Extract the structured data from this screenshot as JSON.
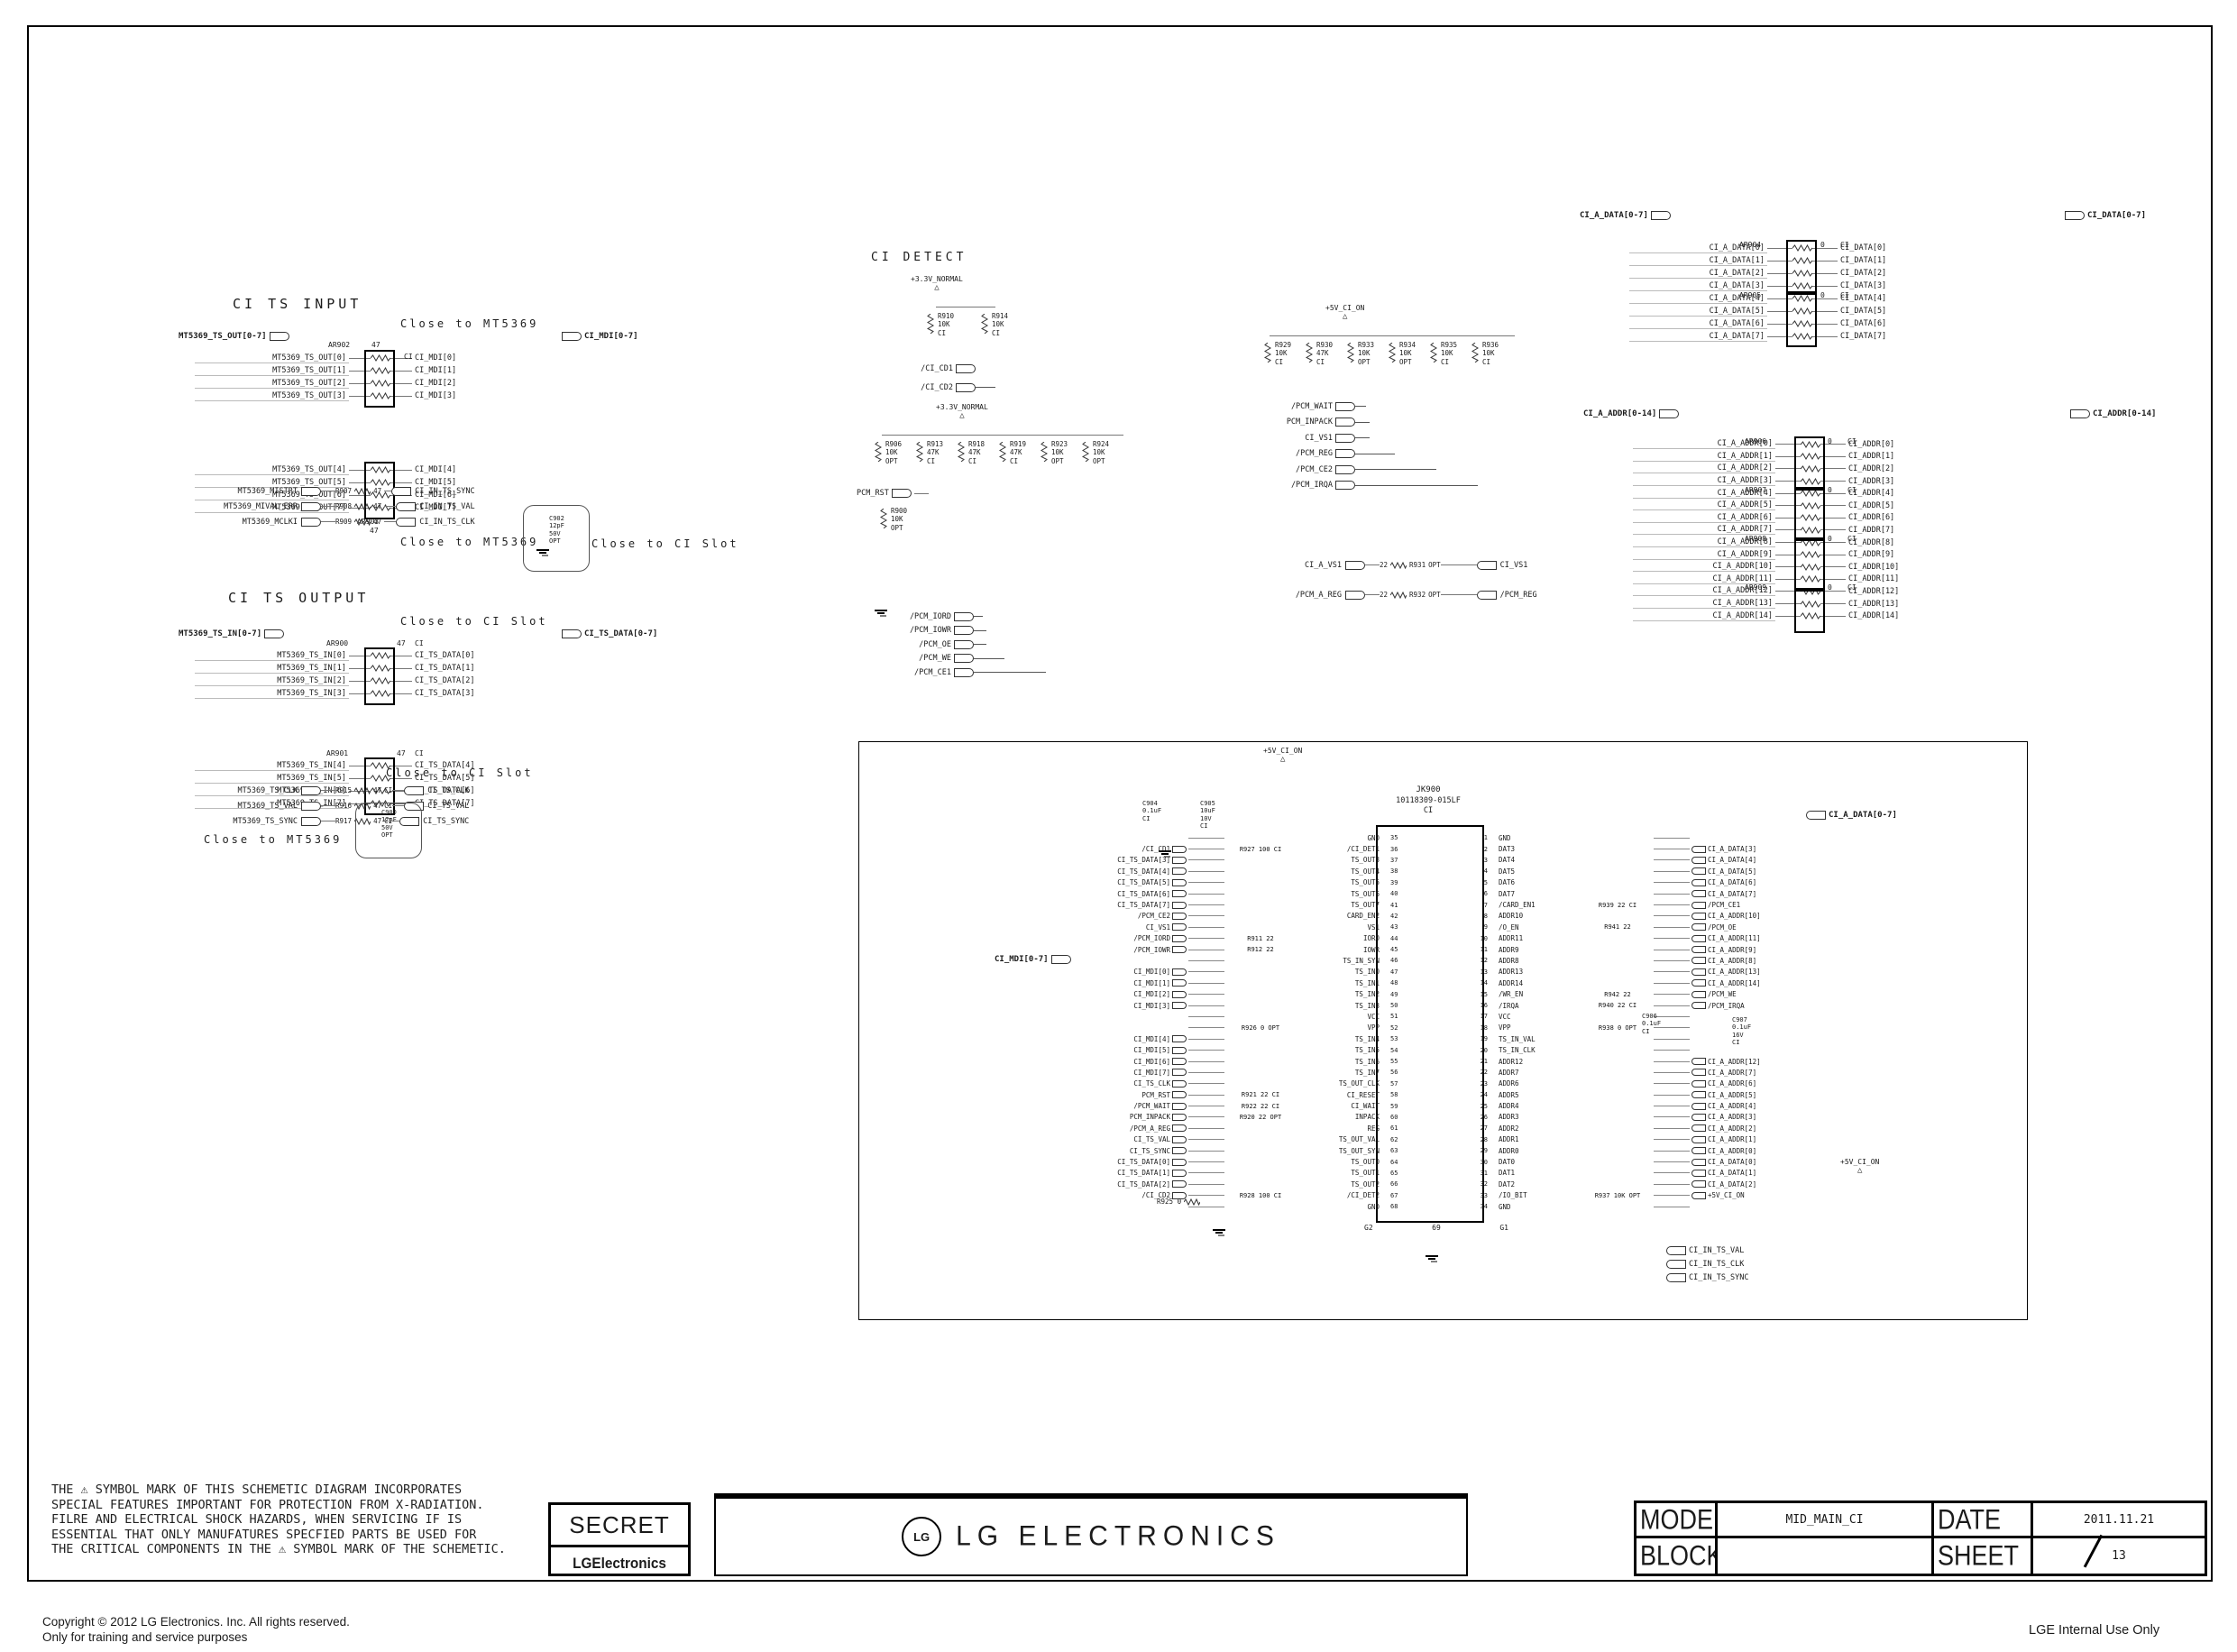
{
  "page": {
    "copyright1": "Copyright © 2012 LG Electronics. Inc. All rights reserved.",
    "copyright2": "Only for training and service purposes",
    "internal": "LGE Internal Use Only"
  },
  "legend": {
    "disclaimer": [
      "THE ⚠ SYMBOL MARK OF THIS SCHEMETIC DIAGRAM INCORPORATES",
      "SPECIAL FEATURES IMPORTANT FOR PROTECTION FROM X-RADIATION.",
      "FILRE AND ELECTRICAL SHOCK HAZARDS, WHEN SERVICING IF IS",
      "ESSENTIAL THAT ONLY MANUFATURES SPECFIED PARTS BE USED FOR",
      "THE CRITICAL COMPONENTS IN THE ⚠ SYMBOL MARK OF THE SCHEMETIC."
    ],
    "secret": "SECRET",
    "lg_small": "LGElectronics",
    "logo_circle": "LG",
    "logo_text": "LG ELECTRONICS",
    "model_label": "MODEL",
    "model": "MID_MAIN_CI",
    "date_label": "DATE",
    "date": "2011.11.21",
    "block_label": "BLOCK",
    "block": "",
    "sheet_label": "SHEET",
    "sheet": "13"
  },
  "ci_ts_input": {
    "title": "CI TS INPUT",
    "close1": "Close to MT5369",
    "close2": "Close to MT5369",
    "close3": "Close to CI Slot",
    "bus_in": "MT5369_TS_OUT[0-7]",
    "bus_out": "CI_MDI[0-7]",
    "net1": {
      "ref": "AR902",
      "val": "47",
      "tag": "CI"
    },
    "net2": {
      "ref": "AR903",
      "val": "47",
      "tag": "CI"
    },
    "rows1": [
      {
        "l": "MT5369_TS_OUT[0]",
        "r": "CI_MDI[0]"
      },
      {
        "l": "MT5369_TS_OUT[1]",
        "r": "CI_MDI[1]"
      },
      {
        "l": "MT5369_TS_OUT[2]",
        "r": "CI_MDI[2]"
      },
      {
        "l": "MT5369_TS_OUT[3]",
        "r": "CI_MDI[3]"
      }
    ],
    "rows2": [
      {
        "l": "MT5369_TS_OUT[4]",
        "r": "CI_MDI[4]"
      },
      {
        "l": "MT5369_TS_OUT[5]",
        "r": "CI_MDI[5]"
      },
      {
        "l": "MT5369_TS_OUT[6]",
        "r": "CI_MDI[6]"
      },
      {
        "l": "MT5369_TS_OUT[7]",
        "r": "CI_MDI[7]"
      }
    ],
    "series": [
      {
        "l": "MT5369_MISTRT",
        "ref": "R907",
        "val": "47",
        "tag": "",
        "r": "CI_IN_TS_SYNC"
      },
      {
        "l": "MT5369_MIVAL_ERR",
        "ref": "R908",
        "val": "47",
        "tag": "",
        "r": "CI_IN_TS_VAL"
      },
      {
        "l": "MT5369_MCLKI",
        "ref": "R909",
        "val": "47",
        "tag": "",
        "r": "CI_IN_TS_CLK"
      }
    ],
    "cap": {
      "ref": "C902",
      "v": "12pF",
      "volt": "50V",
      "tag": "OPT"
    }
  },
  "ci_ts_output": {
    "title": "CI TS OUTPUT",
    "close1": "Close to CI Slot",
    "close2": "Close to CI Slot",
    "close3": "Close to MT5369",
    "bus_in": "MT5369_TS_IN[0-7]",
    "bus_out": "CI_TS_DATA[0-7]",
    "net1": {
      "ref": "AR900",
      "val": "47",
      "tag": "CI"
    },
    "net2": {
      "ref": "AR901",
      "val": "47",
      "tag": "CI"
    },
    "rows1": [
      {
        "l": "MT5369_TS_IN[0]",
        "r": "CI_TS_DATA[0]"
      },
      {
        "l": "MT5369_TS_IN[1]",
        "r": "CI_TS_DATA[1]"
      },
      {
        "l": "MT5369_TS_IN[2]",
        "r": "CI_TS_DATA[2]"
      },
      {
        "l": "MT5369_TS_IN[3]",
        "r": "CI_TS_DATA[3]"
      }
    ],
    "rows2": [
      {
        "l": "MT5369_TS_IN[4]",
        "r": "CI_TS_DATA[4]"
      },
      {
        "l": "MT5369_TS_IN[5]",
        "r": "CI_TS_DATA[5]"
      },
      {
        "l": "MT5369_TS_IN[6]",
        "r": "CI_TS_DATA[6]"
      },
      {
        "l": "MT5369_TS_IN[7]",
        "r": "CI_TS_DATA[7]"
      }
    ],
    "series": [
      {
        "l": "MT5369_TS_CLK",
        "ref": "R915",
        "val": "47",
        "tag": "CI",
        "r": "CI_TS_CLK"
      },
      {
        "l": "MT5369_TS_VAL",
        "ref": "R916",
        "val": "47",
        "tag": "CI",
        "r": "CI_TS_VAL"
      },
      {
        "l": "MT5369_TS_SYNC",
        "ref": "R917",
        "val": "47",
        "tag": "CI",
        "r": "CI_TS_SYNC"
      }
    ],
    "cap": {
      "ref": "C900",
      "v": "12pF",
      "volt": "50V",
      "tag": "OPT"
    }
  },
  "ci_detect": {
    "title": "CI DETECT",
    "power": "+3.3V_NORMAL",
    "res": [
      {
        "ref": "R910",
        "val": "10K",
        "tag": "CI"
      },
      {
        "ref": "R914",
        "val": "10K",
        "tag": "CI"
      }
    ],
    "sigs": [
      "/CI_CD1",
      "/CI_CD2"
    ]
  },
  "pullup33": {
    "power": "+3.3V_NORMAL",
    "res": [
      {
        "ref": "R906",
        "val": "10K",
        "tag": "OPT"
      },
      {
        "ref": "R913",
        "val": "47K",
        "tag": "CI"
      },
      {
        "ref": "R918",
        "val": "47K",
        "tag": "CI"
      },
      {
        "ref": "R919",
        "val": "47K",
        "tag": "CI"
      },
      {
        "ref": "R923",
        "val": "10K",
        "tag": "OPT"
      },
      {
        "ref": "R924",
        "val": "10K",
        "tag": "OPT"
      }
    ],
    "pull_sig": "PCM_RST",
    "pull_res": {
      "ref": "R900",
      "val": "10K",
      "tag": "OPT"
    },
    "sigs": [
      "/PCM_IORD",
      "/PCM_IOWR",
      "/PCM_OE",
      "/PCM_WE",
      "/PCM_CE1"
    ]
  },
  "pullup5v": {
    "power": "+5V_CI_ON",
    "res": [
      {
        "ref": "R929",
        "val": "10K",
        "tag": "CI"
      },
      {
        "ref": "R930",
        "val": "47K",
        "tag": "CI"
      },
      {
        "ref": "R933",
        "val": "10K",
        "tag": "OPT"
      },
      {
        "ref": "R934",
        "val": "10K",
        "tag": "OPT"
      },
      {
        "ref": "R935",
        "val": "10K",
        "tag": "CI"
      },
      {
        "ref": "R936",
        "val": "10K",
        "tag": "CI"
      }
    ],
    "sigs": [
      "/PCM_WAIT",
      "PCM_INPACK",
      "CI_VS1",
      "/PCM_REG",
      "/PCM_CE2",
      "/PCM_IRQA"
    ],
    "jumpers": [
      {
        "l": "CI_A_VS1",
        "ref": "R931",
        "val": "22",
        "tag": "OPT",
        "r": "CI_VS1"
      },
      {
        "l": "/PCM_A_REG",
        "ref": "R932",
        "val": "22",
        "tag": "OPT",
        "r": "/PCM_REG"
      }
    ]
  },
  "databus": {
    "bus_in": "CI_A_DATA[0-7]",
    "bus_out": "CI_DATA[0-7]",
    "nets": [
      {
        "ref": "AR904",
        "val": "0",
        "tag": "CI"
      },
      {
        "ref": "AR905",
        "val": "0",
        "tag": "CI"
      }
    ],
    "rows": [
      {
        "l": "CI_A_DATA[0]",
        "r": "CI_DATA[0]"
      },
      {
        "l": "CI_A_DATA[1]",
        "r": "CI_DATA[1]"
      },
      {
        "l": "CI_A_DATA[2]",
        "r": "CI_DATA[2]"
      },
      {
        "l": "CI_A_DATA[3]",
        "r": "CI_DATA[3]"
      },
      {
        "l": "CI_A_DATA[4]",
        "r": "CI_DATA[4]"
      },
      {
        "l": "CI_A_DATA[5]",
        "r": "CI_DATA[5]"
      },
      {
        "l": "CI_A_DATA[6]",
        "r": "CI_DATA[6]"
      },
      {
        "l": "CI_A_DATA[7]",
        "r": "CI_DATA[7]"
      }
    ]
  },
  "addrbus": {
    "bus_in": "CI_A_ADDR[0-14]",
    "bus_out": "CI_ADDR[0-14]",
    "nets": [
      {
        "ref": "AR906",
        "val": "0",
        "tag": "CI"
      },
      {
        "ref": "AR907",
        "val": "0",
        "tag": "CI"
      },
      {
        "ref": "AR908",
        "val": "0",
        "tag": "CI"
      },
      {
        "ref": "AR909",
        "val": "0",
        "tag": "CI"
      }
    ],
    "rows": [
      {
        "l": "CI_A_ADDR[0]",
        "r": "CI_ADDR[0]"
      },
      {
        "l": "CI_A_ADDR[1]",
        "r": "CI_ADDR[1]"
      },
      {
        "l": "CI_A_ADDR[2]",
        "r": "CI_ADDR[2]"
      },
      {
        "l": "CI_A_ADDR[3]",
        "r": "CI_ADDR[3]"
      },
      {
        "l": "CI_A_ADDR[4]",
        "r": "CI_ADDR[4]"
      },
      {
        "l": "CI_A_ADDR[5]",
        "r": "CI_ADDR[5]"
      },
      {
        "l": "CI_A_ADDR[6]",
        "r": "CI_ADDR[6]"
      },
      {
        "l": "CI_A_ADDR[7]",
        "r": "CI_ADDR[7]"
      },
      {
        "l": "CI_A_ADDR[8]",
        "r": "CI_ADDR[8]"
      },
      {
        "l": "CI_A_ADDR[9]",
        "r": "CI_ADDR[9]"
      },
      {
        "l": "CI_A_ADDR[10]",
        "r": "CI_ADDR[10]"
      },
      {
        "l": "CI_A_ADDR[11]",
        "r": "CI_ADDR[11]"
      },
      {
        "l": "CI_A_ADDR[12]",
        "r": "CI_ADDR[12]"
      },
      {
        "l": "CI_A_ADDR[13]",
        "r": "CI_ADDR[13]"
      },
      {
        "l": "CI_A_ADDR[14]",
        "r": "CI_ADDR[14]"
      }
    ]
  },
  "main": {
    "power": "+5V_CI_ON",
    "power2": "+5V_CI_ON",
    "mdi_bus": "CI_MDI[0-7]",
    "data_bus": "CI_A_DATA[0-7]",
    "c904": {
      "ref": "C904",
      "v": "0.1uF",
      "tag": "CI"
    },
    "c905": {
      "ref": "C905",
      "v": "10uF",
      "volt": "10V",
      "tag": "CI"
    },
    "c906": {
      "ref": "C906",
      "v": "0.1uF",
      "tag": "CI"
    },
    "c907": {
      "ref": "C907",
      "v": "0.1uF",
      "volt": "16V",
      "tag": "CI"
    },
    "r925": "R925 0",
    "outs": [
      "CI_IN_TS_VAL",
      "CI_IN_TS_CLK",
      "CI_IN_TS_SYNC"
    ]
  },
  "ic": {
    "ref": "JK900",
    "part": "10118309-015LF",
    "tag": "CI",
    "g2": "G2",
    "p69": "69",
    "g1": "G1",
    "rows": [
      {
        "el": "",
        "lr": "",
        "ln": "GND",
        "lp": "35",
        "rp": "1",
        "rn": "GND",
        "rr": "",
        "er": ""
      },
      {
        "el": "/CI_CD1",
        "lr": "R927 100 CI",
        "ln": "/CI_DET1",
        "lp": "36",
        "rp": "2",
        "rn": "DAT3",
        "rr": "",
        "er": "CI_A_DATA[3]"
      },
      {
        "el": "CI_TS_DATA[3]",
        "lr": "",
        "ln": "TS_OUT3",
        "lp": "37",
        "rp": "3",
        "rn": "DAT4",
        "rr": "",
        "er": "CI_A_DATA[4]"
      },
      {
        "el": "CI_TS_DATA[4]",
        "lr": "",
        "ln": "TS_OUT4",
        "lp": "38",
        "rp": "4",
        "rn": "DAT5",
        "rr": "",
        "er": "CI_A_DATA[5]"
      },
      {
        "el": "CI_TS_DATA[5]",
        "lr": "",
        "ln": "TS_OUT5",
        "lp": "39",
        "rp": "5",
        "rn": "DAT6",
        "rr": "",
        "er": "CI_A_DATA[6]"
      },
      {
        "el": "CI_TS_DATA[6]",
        "lr": "",
        "ln": "TS_OUT6",
        "lp": "40",
        "rp": "6",
        "rn": "DAT7",
        "rr": "",
        "er": "CI_A_DATA[7]"
      },
      {
        "el": "CI_TS_DATA[7]",
        "lr": "",
        "ln": "TS_OUT7",
        "lp": "41",
        "rp": "7",
        "rn": "/CARD_EN1",
        "rr": "R939 22 CI",
        "er": "/PCM_CE1"
      },
      {
        "el": "/PCM_CE2",
        "lr": "",
        "ln": "CARD_EN2",
        "lp": "42",
        "rp": "8",
        "rn": "ADDR10",
        "rr": "",
        "er": "CI_A_ADDR[10]"
      },
      {
        "el": "CI_VS1",
        "lr": "",
        "ln": "VS1",
        "lp": "43",
        "rp": "9",
        "rn": "/O_EN",
        "rr": "R941 22",
        "er": "/PCM_OE"
      },
      {
        "el": "/PCM_IORD",
        "lr": "R911 22",
        "ln": "IORD",
        "lp": "44",
        "rp": "10",
        "rn": "ADDR11",
        "rr": "",
        "er": "CI_A_ADDR[11]"
      },
      {
        "el": "/PCM_IOWR",
        "lr": "R912 22",
        "ln": "IOWR",
        "lp": "45",
        "rp": "11",
        "rn": "ADDR9",
        "rr": "",
        "er": "CI_A_ADDR[9]"
      },
      {
        "el": "",
        "lr": "",
        "ln": "TS_IN_SYN",
        "lp": "46",
        "rp": "12",
        "rn": "ADDR8",
        "rr": "",
        "er": "CI_A_ADDR[8]"
      },
      {
        "el": "CI_MDI[0]",
        "lr": "",
        "ln": "TS_IN0",
        "lp": "47",
        "rp": "13",
        "rn": "ADDR13",
        "rr": "",
        "er": "CI_A_ADDR[13]"
      },
      {
        "el": "CI_MDI[1]",
        "lr": "",
        "ln": "TS_IN1",
        "lp": "48",
        "rp": "14",
        "rn": "ADDR14",
        "rr": "",
        "er": "CI_A_ADDR[14]"
      },
      {
        "el": "CI_MDI[2]",
        "lr": "",
        "ln": "TS_IN2",
        "lp": "49",
        "rp": "15",
        "rn": "/WR_EN",
        "rr": "R942 22",
        "er": "/PCM_WE"
      },
      {
        "el": "CI_MDI[3]",
        "lr": "",
        "ln": "TS_IN3",
        "lp": "50",
        "rp": "16",
        "rn": "/IRQA",
        "rr": "R940 22 CI",
        "er": "/PCM_IRQA"
      },
      {
        "el": "",
        "lr": "",
        "ln": "VCC",
        "lp": "51",
        "rp": "17",
        "rn": "VCC",
        "rr": "",
        "er": ""
      },
      {
        "el": "",
        "lr": "R926 0 OPT",
        "ln": "VPP",
        "lp": "52",
        "rp": "18",
        "rn": "VPP",
        "rr": "R938 0 OPT",
        "er": ""
      },
      {
        "el": "CI_MDI[4]",
        "lr": "",
        "ln": "TS_IN4",
        "lp": "53",
        "rp": "19",
        "rn": "TS_IN_VAL",
        "rr": "",
        "er": ""
      },
      {
        "el": "CI_MDI[5]",
        "lr": "",
        "ln": "TS_IN5",
        "lp": "54",
        "rp": "20",
        "rn": "TS_IN_CLK",
        "rr": "",
        "er": ""
      },
      {
        "el": "CI_MDI[6]",
        "lr": "",
        "ln": "TS_IN6",
        "lp": "55",
        "rp": "21",
        "rn": "ADDR12",
        "rr": "",
        "er": "CI_A_ADDR[12]"
      },
      {
        "el": "CI_MDI[7]",
        "lr": "",
        "ln": "TS_IN7",
        "lp": "56",
        "rp": "22",
        "rn": "ADDR7",
        "rr": "",
        "er": "CI_A_ADDR[7]"
      },
      {
        "el": "CI_TS_CLK",
        "lr": "",
        "ln": "TS_OUT_CLK",
        "lp": "57",
        "rp": "23",
        "rn": "ADDR6",
        "rr": "",
        "er": "CI_A_ADDR[6]"
      },
      {
        "el": "PCM_RST",
        "lr": "R921 22 CI",
        "ln": "CI_RESET",
        "lp": "58",
        "rp": "24",
        "rn": "ADDR5",
        "rr": "",
        "er": "CI_A_ADDR[5]"
      },
      {
        "el": "/PCM_WAIT",
        "lr": "R922 22 CI",
        "ln": "CI_WAIT",
        "lp": "59",
        "rp": "25",
        "rn": "ADDR4",
        "rr": "",
        "er": "CI_A_ADDR[4]"
      },
      {
        "el": "PCM_INPACK",
        "lr": "R920 22 OPT",
        "ln": "INPACK",
        "lp": "60",
        "rp": "26",
        "rn": "ADDR3",
        "rr": "",
        "er": "CI_A_ADDR[3]"
      },
      {
        "el": "/PCM_A_REG",
        "lr": "",
        "ln": "REG",
        "lp": "61",
        "rp": "27",
        "rn": "ADDR2",
        "rr": "",
        "er": "CI_A_ADDR[2]"
      },
      {
        "el": "CI_TS_VAL",
        "lr": "",
        "ln": "TS_OUT_VAL",
        "lp": "62",
        "rp": "28",
        "rn": "ADDR1",
        "rr": "",
        "er": "CI_A_ADDR[1]"
      },
      {
        "el": "CI_TS_SYNC",
        "lr": "",
        "ln": "TS_OUT_SYN",
        "lp": "63",
        "rp": "29",
        "rn": "ADDR0",
        "rr": "",
        "er": "CI_A_ADDR[0]"
      },
      {
        "el": "CI_TS_DATA[0]",
        "lr": "",
        "ln": "TS_OUT0",
        "lp": "64",
        "rp": "30",
        "rn": "DAT0",
        "rr": "",
        "er": "CI_A_DATA[0]"
      },
      {
        "el": "CI_TS_DATA[1]",
        "lr": "",
        "ln": "TS_OUT1",
        "lp": "65",
        "rp": "31",
        "rn": "DAT1",
        "rr": "",
        "er": "CI_A_DATA[1]"
      },
      {
        "el": "CI_TS_DATA[2]",
        "lr": "",
        "ln": "TS_OUT2",
        "lp": "66",
        "rp": "32",
        "rn": "DAT2",
        "rr": "",
        "er": "CI_A_DATA[2]"
      },
      {
        "el": "/CI_CD2",
        "lr": "R928 100 CI",
        "ln": "/CI_DET2",
        "lp": "67",
        "rp": "33",
        "rn": "/IO_BIT",
        "rr": "R937 10K OPT",
        "er": "+5V_CI_ON"
      },
      {
        "el": "",
        "lr": "",
        "ln": "GND",
        "lp": "68",
        "rp": "34",
        "rn": "GND",
        "rr": "",
        "er": ""
      }
    ]
  }
}
